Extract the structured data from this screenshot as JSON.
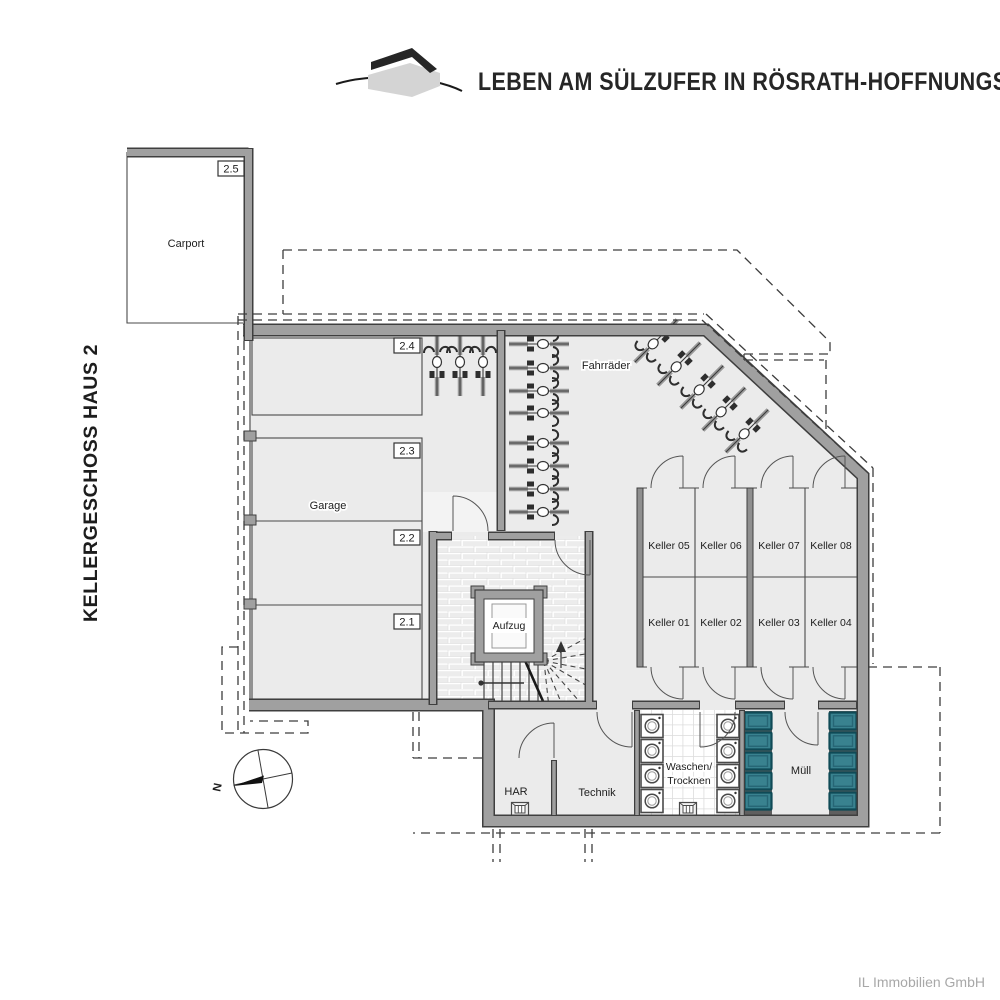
{
  "header": {
    "title": "LEBEN AM SÜLZUFER IN RÖSRATH-HOFFNUNGSTHAL",
    "logo": "house-logo"
  },
  "side_label": "KELLERGESCHOSS HAUS 2",
  "footer": {
    "company": "IL Immobilien GmbH"
  },
  "compass": {
    "north": "N"
  },
  "units": {
    "carport": "2.5",
    "garage_spaces": [
      "2.4",
      "2.3",
      "2.2",
      "2.1"
    ]
  },
  "rooms": {
    "carport": "Carport",
    "garage": "Garage",
    "bikes": "Fahrräder",
    "elevator": "Aufzug",
    "har": "HAR",
    "technik": "Technik",
    "laundry_line1": "Waschen/",
    "laundry_line2": "Trocknen",
    "waste": "Müll",
    "keller": [
      "Keller 01",
      "Keller 02",
      "Keller 03",
      "Keller 04",
      "Keller 05",
      "Keller 06",
      "Keller 07",
      "Keller 08"
    ]
  },
  "colors": {
    "accent_red": "#e30613",
    "bin_teal": "#39828f",
    "wall_gray": "#a0a0a0",
    "floor_gray": "#ebebeb"
  }
}
